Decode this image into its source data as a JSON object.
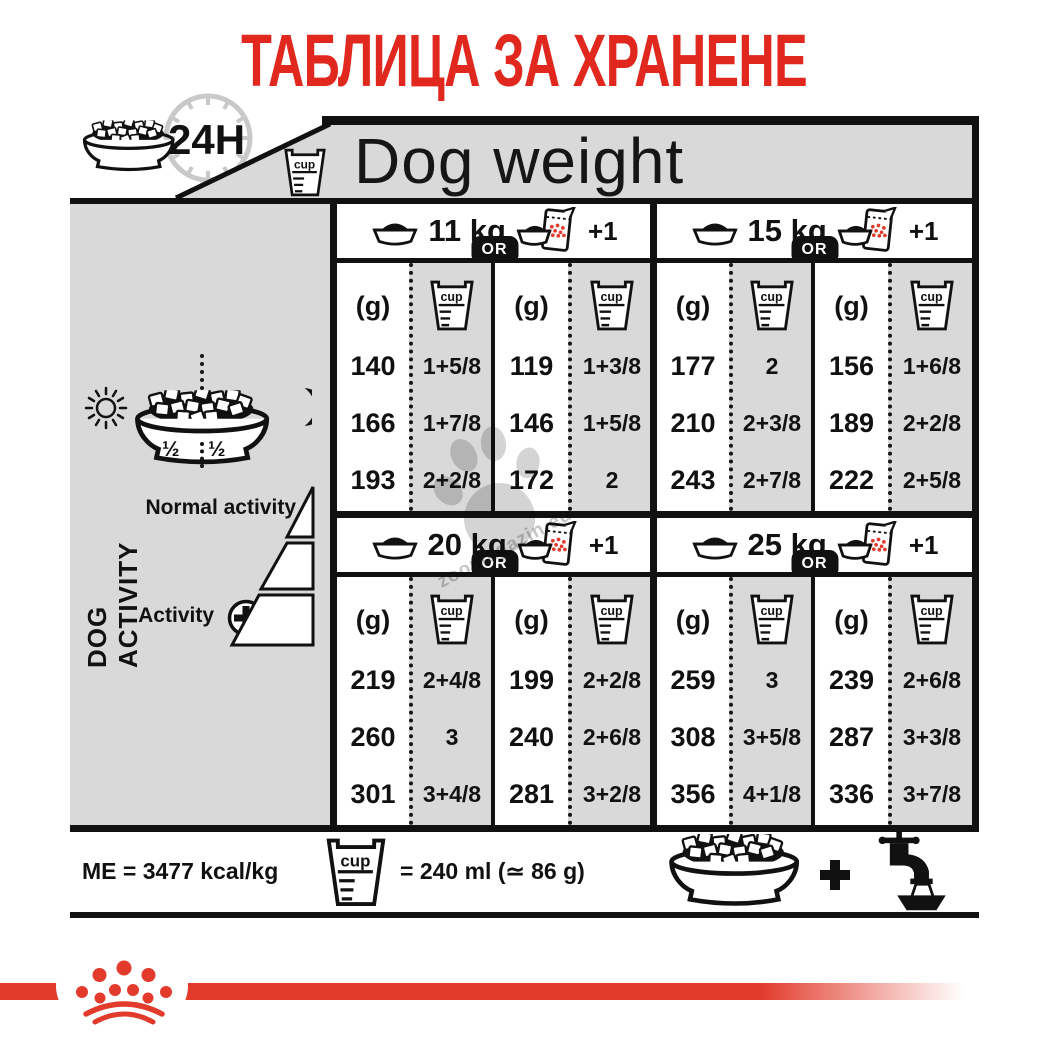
{
  "title": "ТАБЛИЦА ЗА ХРАНЕНЕ",
  "header": {
    "clock_label": "24H",
    "dog_weight_label": "Dog weight",
    "cup_label": "cup"
  },
  "sidebar": {
    "dog_activity_label": "DOG ACTIVITY",
    "bowl_half_left": "½",
    "bowl_half_right": "½",
    "normal_activity_label": "Normal activity",
    "activity_label": "Activity"
  },
  "table_labels": {
    "or": "OR",
    "grams": "(g)",
    "cup": "cup",
    "plus_one": "+1"
  },
  "chart_data": {
    "type": "table",
    "title": "ТАБЛИЦА ЗА ХРАНЕНЕ",
    "column_group_header": "Dog weight",
    "row_axis": {
      "top": "Normal activity",
      "bottom": "Activity +",
      "note": "3 rows = increasing dog activity"
    },
    "units": {
      "grams": "(g)",
      "cup": "cup",
      "alternative": "OR",
      "wet_pouch": "+1"
    },
    "groups": [
      {
        "weight": "11 kg",
        "dry": {
          "g": [
            "140",
            "166",
            "193"
          ],
          "cup": [
            "1+5/8",
            "1+7/8",
            "2+2/8"
          ]
        },
        "mix": {
          "g": [
            "119",
            "146",
            "172"
          ],
          "cup": [
            "1+3/8",
            "1+5/8",
            "2"
          ]
        }
      },
      {
        "weight": "15 kg",
        "dry": {
          "g": [
            "177",
            "210",
            "243"
          ],
          "cup": [
            "2",
            "2+3/8",
            "2+7/8"
          ]
        },
        "mix": {
          "g": [
            "156",
            "189",
            "222"
          ],
          "cup": [
            "1+6/8",
            "2+2/8",
            "2+5/8"
          ]
        }
      },
      {
        "weight": "20 kg",
        "dry": {
          "g": [
            "219",
            "260",
            "301"
          ],
          "cup": [
            "2+4/8",
            "3",
            "3+4/8"
          ]
        },
        "mix": {
          "g": [
            "199",
            "240",
            "281"
          ],
          "cup": [
            "2+2/8",
            "2+6/8",
            "3+2/8"
          ]
        }
      },
      {
        "weight": "25 kg",
        "dry": {
          "g": [
            "259",
            "308",
            "356"
          ],
          "cup": [
            "3",
            "3+5/8",
            "4+1/8"
          ]
        },
        "mix": {
          "g": [
            "239",
            "287",
            "336"
          ],
          "cup": [
            "2+6/8",
            "3+3/8",
            "3+7/8"
          ]
        }
      }
    ]
  },
  "footer": {
    "me": "ME = 3477 kcal/kg",
    "cup_label": "cup",
    "cup_equiv": "= 240 ml (≃ 86 g)"
  },
  "watermark": "zoomagazin.eu",
  "colors": {
    "red": "#e0281e",
    "logo_red": "#e23b2c",
    "panel_gray": "#d9d9d9",
    "clock_gray": "#c9c9c9",
    "ink": "#111111"
  }
}
